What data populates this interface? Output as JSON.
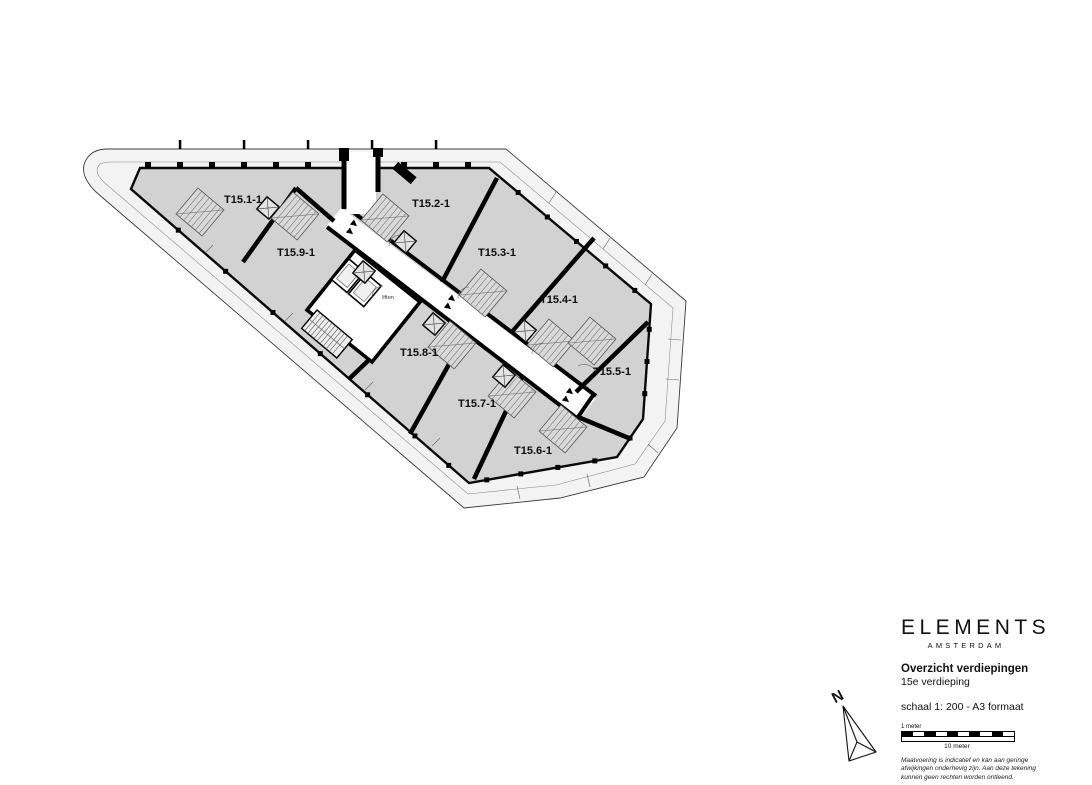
{
  "drawing": {
    "units": [
      {
        "label": "T15.1-1",
        "x": 243,
        "y": 203
      },
      {
        "label": "T15.2-1",
        "x": 431,
        "y": 207
      },
      {
        "label": "T15.9-1",
        "x": 296,
        "y": 256
      },
      {
        "label": "T15.3-1",
        "x": 497,
        "y": 256
      },
      {
        "label": "T15.4-1",
        "x": 559,
        "y": 303
      },
      {
        "label": "T15.8-1",
        "x": 419,
        "y": 356
      },
      {
        "label": "T15.5-1",
        "x": 612,
        "y": 375
      },
      {
        "label": "T15.7-1",
        "x": 477,
        "y": 407
      },
      {
        "label": "T15.6-1",
        "x": 533,
        "y": 454
      }
    ],
    "core_label": "liften"
  },
  "title_block": {
    "brand": "ELEMENTS",
    "brand_sub": "AMSTERDAM",
    "title": "Overzicht verdiepingen",
    "subtitle": "15e verdieping",
    "scale_note": "schaal 1: 200 - A3 formaat",
    "north_label": "N",
    "scalebar": {
      "label_top": "1 meter",
      "label_bottom": "10 meter",
      "segments": 10
    },
    "disclaimer": [
      "Maatvoering is indicatief en kan aan geringe",
      "afwijkingen onderhevig zijn. Aan deze tekening",
      "kunnen geen rechten worden ontleend."
    ]
  },
  "colors": {
    "apartment_fill": "#d2d2d2",
    "walkway_fill": "#f3f3f3",
    "wall": "#000000",
    "paper": "#ffffff"
  }
}
